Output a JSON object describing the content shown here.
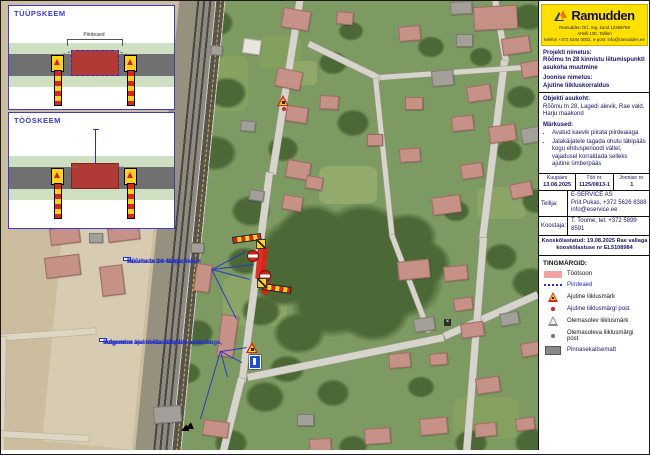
{
  "scheme": {
    "panel1_title": "TÜÜPSKEEM",
    "panel2_title": "TÖÖSKEEM",
    "fence_label": "Piirdeaed"
  },
  "info_panel": {
    "logo": {
      "brand": "Ramudden",
      "address_lines": [
        "Ramudden OÜ, reg. kood 12268769",
        "Artelli 10b, Tallinn",
        "telefon +372 5344 0002, e-post: info@ramudden.ee"
      ]
    },
    "project": {
      "label": "Projekti nimetus:",
      "value": "Rõõmu tn 28 kinnistu liitumispunkti asukoha muutmine"
    },
    "drawing": {
      "label": "Joonise nimetus:",
      "value": "Ajutine liikluskorraldus"
    },
    "location": {
      "label": "Objekti asukoht:",
      "value": "Rõõmu tn 28, Lagedi alevik, Rae vald, Harju maakond"
    },
    "notes": {
      "label": "Märkused:",
      "items": [
        "Avatud kaevik piirata piirdeaiaga",
        "Jalakäijatele tagada ohutu läbipääs kogu ehitusperioodi vältel, vajadusel korraldada selleks ajutine ümberpääs"
      ]
    },
    "meta": {
      "date_label": "Kuupäev",
      "date": "13.08.2025",
      "work_no_label": "Töö nr.",
      "work_no": "1125/0813-1",
      "drawing_no_label": "Joonise nr.",
      "drawing_no": "1"
    },
    "client": {
      "label": "Tellija:",
      "lines": [
        "E-SERVICE AS",
        "Priit Pukas, +372 5626 8388",
        "info@eservice.ee"
      ]
    },
    "author": {
      "label": "Koostaja:",
      "value": "T. Toome, tel. +372 5899 8591"
    },
    "approval": {
      "lines": [
        "Kooskõlastatud: 19.08.2025 Rae vallaga",
        "kooskõlastuse nr EL5108984"
      ]
    },
    "legend": {
      "title": "TINGMÄRGID:",
      "items": [
        {
          "icon": "workzone-swatch",
          "label": "Töötsoon",
          "color": "#f0a3a3"
        },
        {
          "icon": "fence-dotted-line",
          "label": "Piirdeaed",
          "color": "#2230cc"
        },
        {
          "icon": "roadwork-sign-icon",
          "label": "Ajutine liiklusmärk"
        },
        {
          "icon": "red-post-dot",
          "label": "Ajutine liiklusmärgi post"
        },
        {
          "icon": "gray-sign-icon",
          "label": "Olemasolev liiklusmärk"
        },
        {
          "icon": "gray-post-dot",
          "label": "Olemasoleva liiklusmärgi post"
        },
        {
          "icon": "plate-swatch",
          "label": "Pinnasekaitsematt",
          "color": "#8a8a8a"
        }
      ]
    }
  },
  "map": {
    "callouts": [
      {
        "x": 122,
        "y": 256,
        "lines": [
          "Teavitada tee sulgemisest",
          "Rõõmu tn 24-48 elanikke"
        ]
      },
      {
        "x": 98,
        "y": 337,
        "lines": [
          "Sulgemine kooskõlastada tee omanikuga,",
          "sulgemise ajal hoida läbipääs avatuna"
        ]
      }
    ],
    "patches": [
      [
        205,
        55,
        42,
        55,
        "#87a161",
        0
      ],
      [
        258,
        35,
        42,
        32,
        "#83a05e",
        0
      ],
      [
        286,
        60,
        30,
        24,
        "#90a96a",
        0
      ],
      [
        318,
        165,
        58,
        38,
        "#92ab6c",
        0
      ],
      [
        476,
        186,
        48,
        32,
        "#8ba566",
        0
      ],
      [
        222,
        275,
        64,
        50,
        "#8ba566",
        0
      ],
      [
        452,
        396,
        66,
        42,
        "#85a05f",
        0
      ],
      [
        182,
        -6,
        478,
        212,
        "#ccbd9f",
        95.6
      ],
      [
        160,
        150,
        300,
        90,
        "#d7ccb2",
        95.6
      ]
    ],
    "rail": {
      "x": 225,
      "y": -6,
      "l": 474,
      "w": 46,
      "a": 95.6
    },
    "trees": [
      [
        302,
        252,
        46
      ],
      [
        348,
        266,
        56
      ],
      [
        396,
        282,
        46
      ],
      [
        332,
        302,
        42
      ],
      [
        372,
        312,
        36
      ],
      [
        282,
        282,
        30
      ],
      [
        420,
        262,
        30
      ],
      [
        312,
        232,
        36
      ],
      [
        362,
        236,
        42
      ],
      [
        406,
        236,
        30
      ],
      [
        298,
        332,
        26
      ],
      [
        215,
        22,
        18
      ],
      [
        226,
        92,
        20
      ],
      [
        214,
        152,
        22
      ],
      [
        250,
        210,
        20
      ],
      [
        332,
        62,
        15
      ],
      [
        430,
        46,
        14
      ],
      [
        528,
        16,
        18
      ],
      [
        520,
        96,
        15
      ],
      [
        480,
        56,
        12
      ],
      [
        352,
        122,
        17
      ],
      [
        282,
        148,
        16
      ],
      [
        244,
        260,
        18
      ],
      [
        260,
        310,
        20
      ],
      [
        286,
        368,
        18
      ],
      [
        264,
        396,
        20
      ],
      [
        332,
        392,
        17
      ],
      [
        420,
        386,
        14
      ],
      [
        530,
        282,
        20
      ],
      [
        500,
        256,
        17
      ],
      [
        470,
        442,
        17
      ],
      [
        352,
        446,
        15
      ],
      [
        230,
        442,
        17
      ],
      [
        532,
        442,
        19
      ],
      [
        182,
        232,
        14
      ],
      [
        196,
        332,
        17
      ],
      [
        186,
        372,
        14
      ],
      [
        508,
        150,
        14
      ],
      [
        536,
        200,
        16
      ],
      [
        350,
        30,
        13
      ],
      [
        455,
        210,
        14
      ]
    ],
    "roads": [
      [
        303,
        -4,
        180,
        7,
        99,
        ""
      ],
      [
        272,
        172,
        212,
        7,
        97.5,
        ""
      ],
      [
        244,
        378,
        90,
        7,
        104,
        ""
      ],
      [
        246,
        373,
        200,
        6.5,
        -11.5,
        ""
      ],
      [
        442,
        332,
        102,
        6.5,
        -24,
        ""
      ],
      [
        497,
        -2,
        64,
        6,
        80,
        ""
      ],
      [
        507,
        60,
        182,
        6.5,
        97,
        ""
      ],
      [
        486,
        237,
        232,
        7,
        94.5,
        ""
      ],
      [
        309,
        40,
        80,
        5.5,
        26,
        ""
      ],
      [
        379,
        74,
        162,
        5,
        -4,
        ""
      ],
      [
        377,
        77,
        158,
        5,
        84,
        ""
      ],
      [
        393,
        233,
        104,
        5,
        69,
        ""
      ],
      [
        95,
        333,
        97,
        6,
        176,
        "c"
      ],
      [
        5,
        336,
        124,
        6,
        91,
        "c"
      ],
      [
        0,
        430,
        88,
        6,
        3,
        "c"
      ]
    ],
    "houses": [
      [
        283,
        6,
        26,
        18,
        10,
        "p"
      ],
      [
        472,
        6,
        42,
        22,
        -3,
        "p"
      ],
      [
        449,
        1,
        20,
        11,
        -3,
        "g"
      ],
      [
        336,
        10,
        15,
        11,
        5,
        "p"
      ],
      [
        397,
        26,
        20,
        13,
        -5,
        "p"
      ],
      [
        500,
        38,
        26,
        15,
        -8,
        "p"
      ],
      [
        455,
        33,
        15,
        11,
        0,
        "g"
      ],
      [
        277,
        66,
        24,
        17,
        12,
        "p"
      ],
      [
        243,
        37,
        16,
        13,
        8,
        "w"
      ],
      [
        430,
        70,
        20,
        14,
        -5,
        "g"
      ],
      [
        519,
        62,
        20,
        14,
        -10,
        "p"
      ],
      [
        465,
        86,
        22,
        14,
        -8,
        "p"
      ],
      [
        319,
        94,
        17,
        12,
        3,
        "p"
      ],
      [
        404,
        96,
        16,
        11,
        0,
        "p"
      ],
      [
        286,
        104,
        20,
        14,
        8,
        "p"
      ],
      [
        450,
        116,
        20,
        13,
        -6,
        "p"
      ],
      [
        487,
        126,
        25,
        15,
        -8,
        "p"
      ],
      [
        519,
        128,
        22,
        14,
        -10,
        "g"
      ],
      [
        287,
        158,
        22,
        16,
        10,
        "p"
      ],
      [
        306,
        174,
        15,
        11,
        10,
        "p"
      ],
      [
        366,
        133,
        14,
        10,
        0,
        "p"
      ],
      [
        398,
        148,
        19,
        12,
        -4,
        "p"
      ],
      [
        430,
        197,
        27,
        16,
        -8,
        "p"
      ],
      [
        508,
        184,
        20,
        13,
        -12,
        "p"
      ],
      [
        459,
        164,
        20,
        13,
        -8,
        "p"
      ],
      [
        283,
        193,
        18,
        13,
        10,
        "p"
      ],
      [
        240,
        119,
        13,
        9,
        5,
        "g"
      ],
      [
        249,
        188,
        13,
        9,
        8,
        "g"
      ],
      [
        210,
        44,
        10,
        8,
        5,
        "g"
      ],
      [
        396,
        261,
        30,
        17,
        -6,
        "p"
      ],
      [
        442,
        266,
        22,
        13,
        -6,
        "p"
      ],
      [
        452,
        298,
        17,
        11,
        -8,
        "p"
      ],
      [
        412,
        318,
        19,
        12,
        -8,
        "g"
      ],
      [
        459,
        323,
        21,
        13,
        -8,
        "p"
      ],
      [
        498,
        313,
        17,
        11,
        -10,
        "g"
      ],
      [
        387,
        353,
        20,
        13,
        -5,
        "p"
      ],
      [
        428,
        353,
        16,
        10,
        -5,
        "p"
      ],
      [
        474,
        378,
        22,
        14,
        -8,
        "p"
      ],
      [
        519,
        343,
        19,
        12,
        -10,
        "p"
      ],
      [
        418,
        418,
        26,
        15,
        -5,
        "p"
      ],
      [
        473,
        423,
        20,
        12,
        -6,
        "p"
      ],
      [
        514,
        418,
        17,
        11,
        -8,
        "p"
      ],
      [
        363,
        428,
        24,
        14,
        -4,
        "p"
      ],
      [
        308,
        438,
        20,
        12,
        -3,
        "p"
      ],
      [
        296,
        413,
        15,
        10,
        0,
        "g"
      ],
      [
        203,
        418,
        24,
        14,
        8,
        "p"
      ],
      [
        221,
        313,
        15,
        40,
        8,
        "p"
      ],
      [
        196,
        262,
        14,
        26,
        8,
        "p"
      ],
      [
        190,
        242,
        11,
        8,
        0,
        "g"
      ],
      [
        152,
        406,
        26,
        15,
        -4,
        "g"
      ],
      [
        48,
        228,
        28,
        15,
        -7,
        "p"
      ],
      [
        106,
        228,
        30,
        12,
        -7,
        "p"
      ],
      [
        43,
        257,
        33,
        19,
        -7,
        "p"
      ],
      [
        98,
        266,
        21,
        28,
        -7,
        "p"
      ],
      [
        88,
        232,
        12,
        8,
        0,
        "g"
      ]
    ],
    "leaders": [
      [
        211,
        268,
        245,
        250
      ],
      [
        211,
        268,
        253,
        263
      ],
      [
        211,
        268,
        249,
        278
      ],
      [
        211,
        268,
        236,
        318
      ],
      [
        220,
        350,
        246,
        346
      ],
      [
        220,
        350,
        241,
        361
      ],
      [
        220,
        350,
        227,
        376
      ],
      [
        220,
        350,
        200,
        418
      ]
    ],
    "signs": [
      {
        "t": "worktri",
        "x": 276,
        "y": 94
      },
      {
        "t": "postdot",
        "x": 281,
        "y": 106
      },
      {
        "t": "redblob",
        "x": 257,
        "y": 245,
        "w": 10,
        "h": 33,
        "a": 5
      },
      {
        "t": "redblob",
        "x": 263,
        "y": 280,
        "w": 7,
        "h": 13,
        "a": 12
      },
      {
        "t": "barrier",
        "x": 231,
        "y": 236,
        "l": 27,
        "a": -8
      },
      {
        "t": "arrowplate",
        "x": 255,
        "y": 238
      },
      {
        "t": "noentry",
        "x": 246,
        "y": 249
      },
      {
        "t": "noentry",
        "x": 258,
        "y": 269
      },
      {
        "t": "arrowplate",
        "x": 256,
        "y": 277
      },
      {
        "t": "barrier",
        "x": 262,
        "y": 282,
        "l": 27,
        "a": 8
      },
      {
        "t": "worktri",
        "x": 245,
        "y": 341
      },
      {
        "t": "bluesign",
        "x": 248,
        "y": 354
      },
      {
        "t": "blackarrow",
        "x": 180,
        "y": 422
      },
      {
        "t": "xmark",
        "x": 443,
        "y": 318
      }
    ]
  }
}
